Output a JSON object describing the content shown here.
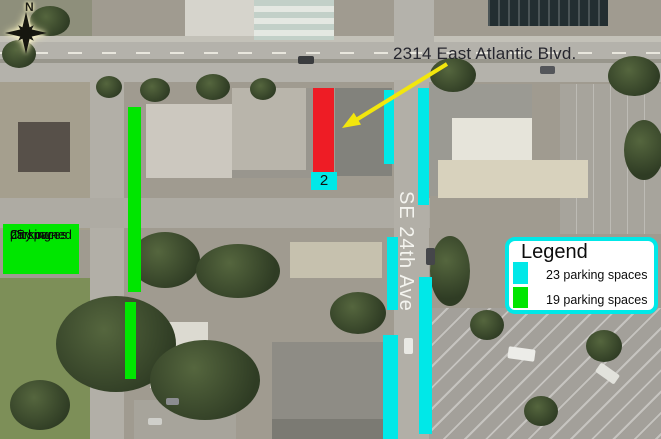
{
  "overlay": {
    "address_label": "2314 East Atlantic Blvd.",
    "street_label": "SE 24th Ave",
    "marker_label": "2",
    "compass_label": "N",
    "city_parking": {
      "line1": "City owned",
      "line2": "parking-",
      "line3": "25 spaces"
    }
  },
  "legend": {
    "title": "Legend",
    "items": [
      {
        "swatch": "cyan",
        "color": "#00e8e8",
        "label": "23 parking spaces"
      },
      {
        "swatch": "green",
        "color": "#00e600",
        "label": "19 parking spaces"
      }
    ]
  },
  "colors": {
    "cyan": "#00e8e8",
    "green": "#00e600",
    "red": "#ee1c25",
    "arrow_yellow": "#f2e60d",
    "legend_border": "#00e8e8"
  }
}
